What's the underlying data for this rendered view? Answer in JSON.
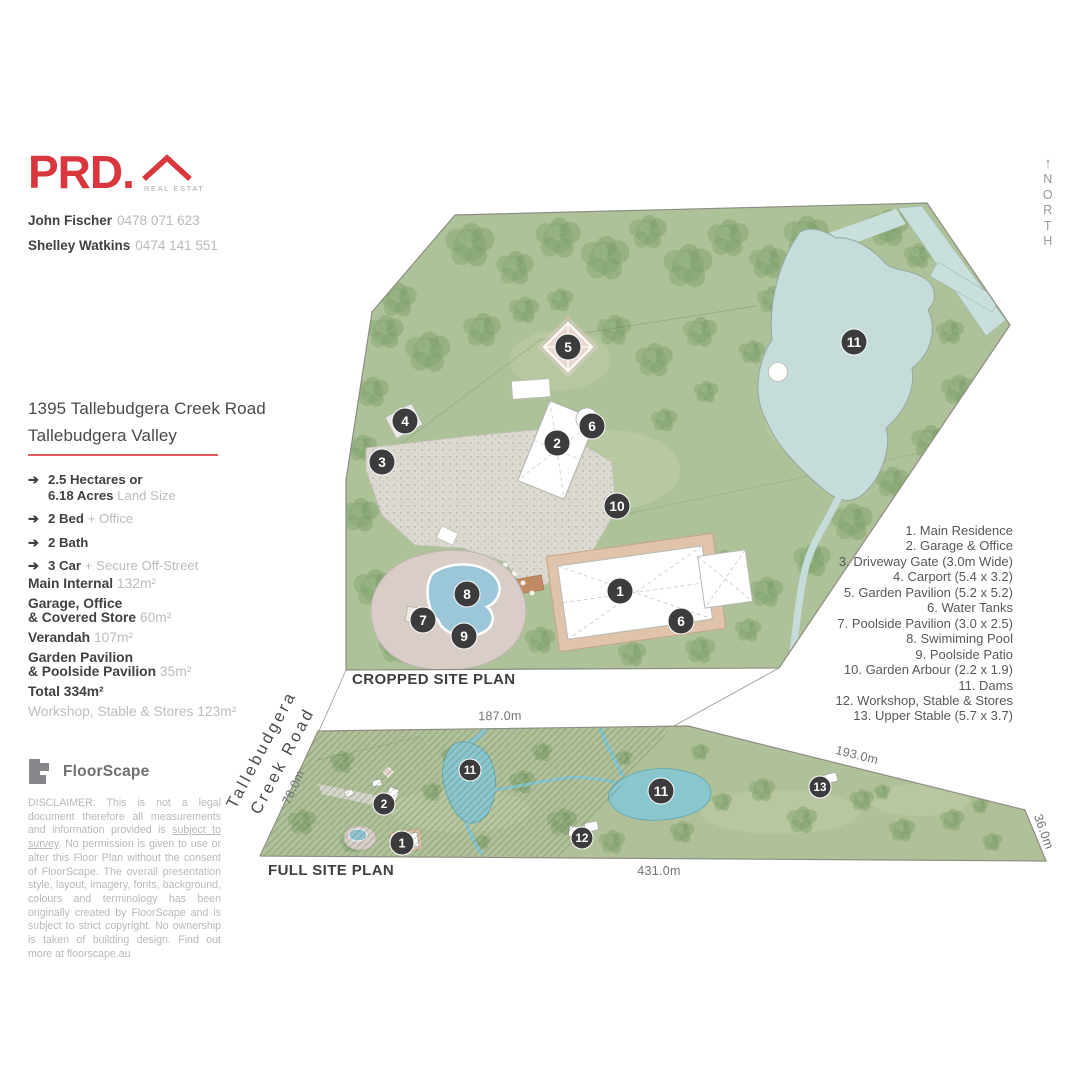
{
  "brand": {
    "name": "PRD.",
    "tagline": "REAL ESTATE"
  },
  "agents": [
    {
      "name": "John Fischer",
      "phone": "0478 071 623"
    },
    {
      "name": "Shelley Watkins",
      "phone": "0474 141 551"
    }
  ],
  "north": {
    "arrow": "↑",
    "letters": "N\nO\nR\nT\nH"
  },
  "property": {
    "address_line1": "1395 Tallebudgera Creek Road",
    "address_line2": "Tallebudgera Valley"
  },
  "features": [
    {
      "lines": [
        {
          "b": "2.5 Hectares or",
          "g": ""
        },
        {
          "b": "6.18 Acres",
          "g": "Land Size"
        }
      ]
    },
    {
      "lines": [
        {
          "b": "2 Bed",
          "g": "+ Office"
        }
      ]
    },
    {
      "lines": [
        {
          "b": "2 Bath",
          "g": ""
        }
      ]
    },
    {
      "lines": [
        {
          "b": "3 Car",
          "g": "+ Secure Off-Street"
        }
      ]
    }
  ],
  "areas": [
    {
      "lines": [
        {
          "b": "Main Internal",
          "g": "132m²"
        }
      ]
    },
    {
      "lines": [
        {
          "b": "Garage, Office",
          "g": ""
        },
        {
          "b": "& Covered Store",
          "g": "60m²"
        }
      ]
    },
    {
      "lines": [
        {
          "b": "Verandah",
          "g": "107m²"
        }
      ]
    },
    {
      "lines": [
        {
          "b": "Garden Pavilion",
          "g": ""
        },
        {
          "b": "& Poolside Pavilion",
          "g": "35m²"
        }
      ]
    },
    {
      "lines": [
        {
          "b": "Total 334m²",
          "g": ""
        }
      ]
    },
    {
      "lines": [
        {
          "b": "",
          "g": "Workshop, Stable & Stores 123m²"
        }
      ]
    }
  ],
  "floorscape": {
    "name": "FloorScape",
    "disclaimer_pre": "DISCLAIMER: This is not a legal document therefore all measurements and information provided is ",
    "disclaimer_underlined": "subject to survey",
    "disclaimer_post": ". No permission is given to use or alter this Floor Plan without the consent of FloorScape. The overall presentation style, layout, imagery, fonts, background, colours and terminology has been originally created by FloorScape and is subject to strict copyright. No ownership is taken of building design. Find out more at floorscape.au"
  },
  "legend": {
    "items": [
      "1. Main Residence",
      "2. Garage & Office",
      "3. Driveway Gate (3.0m Wide)",
      "4. Carport (5.4 x 3.2)",
      "5. Garden Pavilion (5.2 x 5.2)",
      "6. Water Tanks",
      "7. Poolside Pavilion (3.0 x 2.5)",
      "8. Swimiming Pool",
      "9. Poolside Patio",
      "10. Garden Arbour (2.2 x 1.9)",
      "11. Dams",
      "12. Workshop, Stable & Stores",
      "13. Upper Stable (5.7 x 3.7)"
    ]
  },
  "plans": {
    "cropped": {
      "label": "CROPPED SITE PLAN",
      "markers": [
        {
          "n": "1",
          "x": 620,
          "y": 591
        },
        {
          "n": "2",
          "x": 557,
          "y": 443
        },
        {
          "n": "3",
          "x": 382,
          "y": 462
        },
        {
          "n": "4",
          "x": 405,
          "y": 421
        },
        {
          "n": "5",
          "x": 568,
          "y": 347
        },
        {
          "n": "6",
          "x": 592,
          "y": 426
        },
        {
          "n": "6",
          "x": 681,
          "y": 621
        },
        {
          "n": "7",
          "x": 423,
          "y": 620
        },
        {
          "n": "8",
          "x": 467,
          "y": 594
        },
        {
          "n": "9",
          "x": 464,
          "y": 636
        },
        {
          "n": "10",
          "x": 617,
          "y": 506
        },
        {
          "n": "11",
          "x": 854,
          "y": 342
        }
      ]
    },
    "full": {
      "label": "FULL SITE PLAN",
      "road": {
        "line1": "Tallebudgera",
        "line2": "Creek Road",
        "x": 266,
        "y": 752,
        "rot": -62
      },
      "markers": [
        {
          "n": "1",
          "x": 402,
          "y": 843,
          "r": 12
        },
        {
          "n": "2",
          "x": 384,
          "y": 804,
          "r": 11
        },
        {
          "n": "11",
          "x": 470,
          "y": 770,
          "r": 11
        },
        {
          "n": "11",
          "x": 661,
          "y": 791,
          "r": 13
        },
        {
          "n": "12",
          "x": 582,
          "y": 838,
          "r": 11
        },
        {
          "n": "13",
          "x": 820,
          "y": 787,
          "r": 11
        }
      ],
      "measurements": [
        {
          "t": "187.0m",
          "x": 500,
          "y": 720,
          "rot": -0.5
        },
        {
          "t": "78.0m",
          "x": 297,
          "y": 789,
          "rot": -65
        },
        {
          "t": "193.0m",
          "x": 856,
          "y": 759,
          "rot": 14
        },
        {
          "t": "431.0m",
          "x": 659,
          "y": 875,
          "rot": 0
        },
        {
          "t": "36.0m",
          "x": 1040,
          "y": 833,
          "rot": 70
        }
      ]
    }
  }
}
